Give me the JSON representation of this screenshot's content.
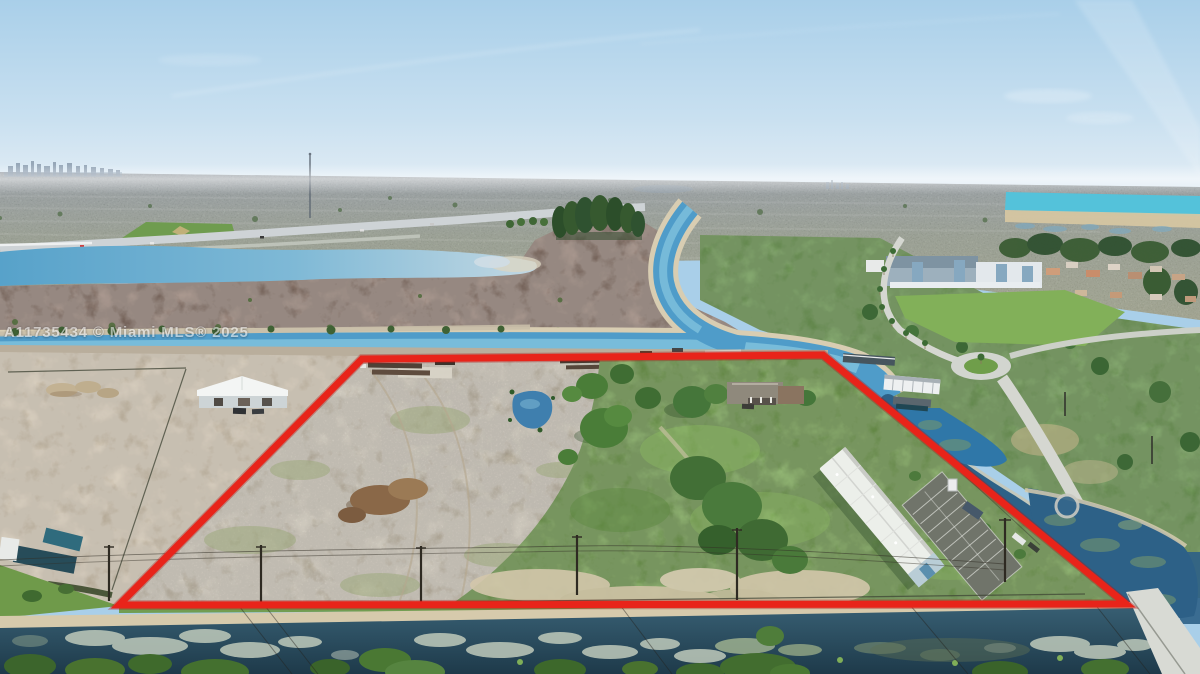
{
  "watermark": {
    "text": "A11735434 © Miami MLS® 2025"
  },
  "colors": {
    "boundary_red": "#e8241a",
    "sky_top": "#a9cfe9",
    "sky_horizon": "#e6eff6",
    "canal_blue": "#4f9cc9",
    "lake_cyan": "#54c2da",
    "pond_dark": "#2d6187",
    "scrub_brown": "#8d7467",
    "sand_tan": "#cdc2ac",
    "grass_green": "#74a24e",
    "lily_gray": "#bfcabb",
    "road_gray": "#d5d7d1",
    "watermark_gray": "#ededed"
  }
}
